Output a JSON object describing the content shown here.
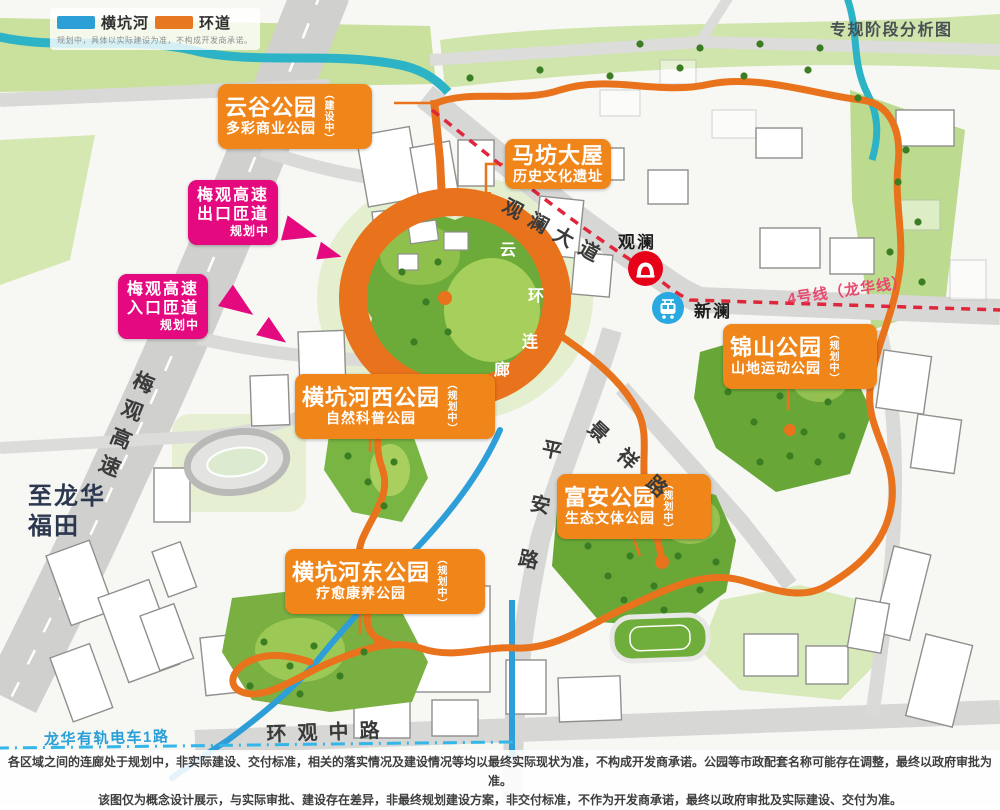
{
  "header": {
    "title": "专规阶段分析图"
  },
  "legend": {
    "items": [
      {
        "label": "横坑河",
        "color": "#2b9fd6"
      },
      {
        "label": "环道",
        "color": "#e87722"
      }
    ],
    "note": "规划中，具体以实际建设为准，不构成开发商承诺。"
  },
  "parks": [
    {
      "name": "云谷公园",
      "subtitle": "多彩商业公园",
      "status": "（建设中）"
    },
    {
      "name": "马坊大屋",
      "subtitle": "历史文化遗址",
      "status": ""
    },
    {
      "name": "横坑河西公园",
      "subtitle": "自然科普公园",
      "status": "（规划中）"
    },
    {
      "name": "横坑河东公园",
      "subtitle": "疗愈康养公园",
      "status": "（规划中）"
    },
    {
      "name": "富安公园",
      "subtitle": "生态文体公园",
      "status": "（规划中）"
    },
    {
      "name": "锦山公园",
      "subtitle": "山地运动公园",
      "status": "（规划中）"
    }
  ],
  "ramps": [
    {
      "line1": "梅观高速",
      "line2": "出口匝道",
      "status": "规划中"
    },
    {
      "line1": "梅观高速",
      "line2": "入口匝道",
      "status": "规划中"
    }
  ],
  "transit": {
    "metro_station": "观澜",
    "tram_station": "新澜",
    "metro_line": "4号线（龙华线）",
    "tram_line": "龙华有轨电车1路",
    "metro_color": "#e0263a",
    "tram_color": "#35b6e8"
  },
  "roads": {
    "guanlan_avenue": "观澜大道",
    "pingan_road": "平安路",
    "jingxiang_road": "景祥路",
    "huanguan_middle_road": "环观中路",
    "meiguan_expressway": "梅观高速",
    "to_longhua_line1": "至龙华",
    "to_longhua_line2": "福田"
  },
  "ring_corridor": {
    "chars": [
      "云",
      "环",
      "连",
      "廊"
    ]
  },
  "footer": {
    "line1": "各区域之间的连廊处于规划中，非实际建设、交付标准，相关的落实情况及建设情况等均以最终实际现状为准，不构成开发商承诺。公园等市政配套名称可能存在调整，最终以政府审批为准。",
    "line2": "该图仅为概念设计展示，与实际审批、建设存在差异，非最终规划建设方案，非交付标准，不作为开发商承诺，最终以政府审批及实际建设、交付为准。"
  }
}
